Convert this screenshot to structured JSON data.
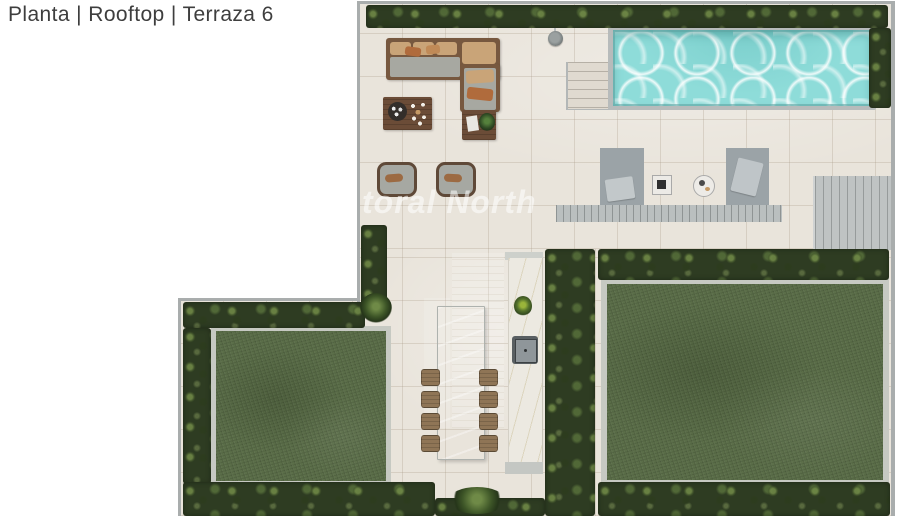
{
  "header": {
    "title": "Planta | Rooftop | Terraza 6"
  },
  "watermark": {
    "text": "toral North"
  },
  "plan": {
    "colors": {
      "background": "#ffffff",
      "tile": "#e9e4db",
      "wall": "#a9adad",
      "hedge_dark": "#2e3c22",
      "grass": "#5b6e49",
      "lawn_border": "#c6c9c2",
      "pool_water": "#8edcd9",
      "pool_rim": "#b7bbbb",
      "deck": "#babfbf",
      "wood_dark": "#6b4c37",
      "sofa_frame": "#77583f",
      "cushion_gray": "#a7a8a1",
      "pillow_tan": "#c9a478",
      "pillow_orange": "#b06b3c",
      "lounger": "#9ba3a7",
      "counter": "#ece9e1",
      "chair_wood": "#8f7556"
    }
  }
}
